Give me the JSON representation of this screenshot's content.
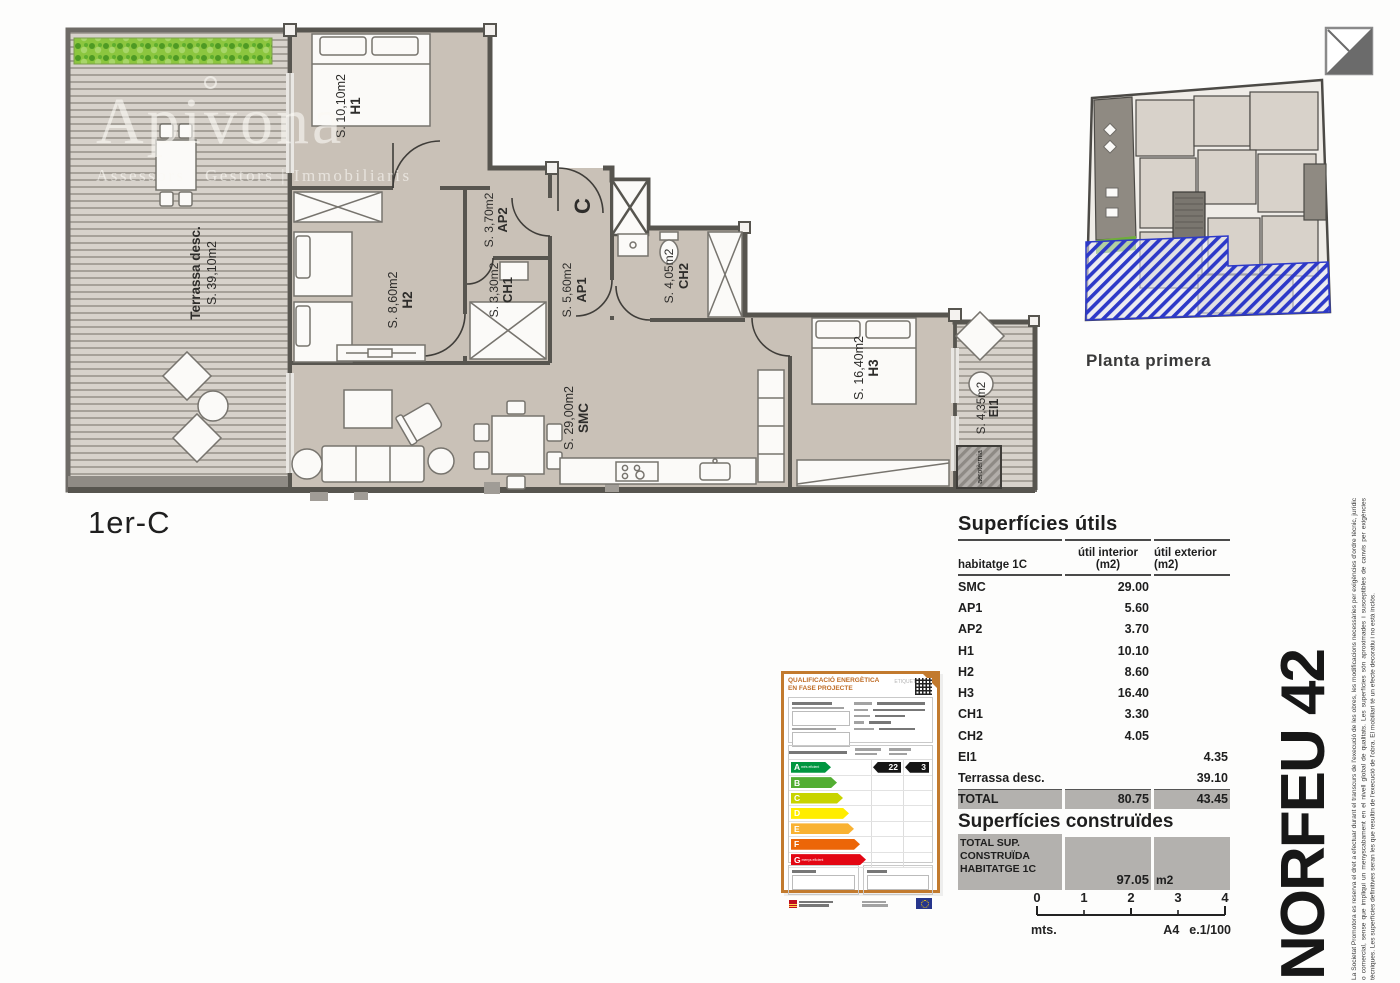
{
  "header": {
    "unit_label": "1er-C",
    "key_plan_label": "Planta primera",
    "brand": "NORFEU 42",
    "disclaimer": "La Societat Promotora es reserva el dret a efectuar durant el transcurs de l'execució de les obres, les modificacions necessàries per exigències d'ordre tècnic, jurídic o comercial, sense que impliqui un menyscabament en el nivell global de qualitats. Les superfícies són aproximades i susceptibles de canvis per exigències tècniques. Les superfícies definitives seran les que resultin de l'execució de l'obra. El mobiliari té un efecte decoratiu i no està inclòs."
  },
  "watermark": {
    "name": "Apivona",
    "tagline": "Assessors | Gestors | Immobiliaris"
  },
  "plan": {
    "rooms": {
      "terrassa": {
        "name": "Terrassa desc.",
        "area": "S. 39,10m2"
      },
      "h1": {
        "name": "H1",
        "area": "S. 10,10m2"
      },
      "h2": {
        "name": "H2",
        "area": "S. 8,60m2"
      },
      "h3": {
        "name": "H3",
        "area": "S. 16,40m2"
      },
      "ap1": {
        "name": "AP1",
        "area": "S. 5,60m2"
      },
      "ap2": {
        "name": "AP2",
        "area": "S. 3,70m2"
      },
      "ch1": {
        "name": "CH1",
        "area": "S. 3,30m2"
      },
      "ch2": {
        "name": "CH2",
        "area": "S. 4,05m2"
      },
      "ei1": {
        "name": "EI1",
        "area": "S. 4,35m2"
      },
      "smc": {
        "name": "SMC",
        "area": "S. 29,00m2"
      }
    },
    "entrance_label": "C",
    "equipment_label": "aerotèrmia"
  },
  "surfaces": {
    "title": "Superfícies útils",
    "columns": {
      "c1": "habitatge 1C",
      "c2a": "útil interior",
      "c2b": "(m2)",
      "c3a": "útil exterior",
      "c3b": "(m2)"
    },
    "rows": [
      {
        "label": "SMC",
        "interior": "29.00",
        "exterior": ""
      },
      {
        "label": "AP1",
        "interior": "5.60",
        "exterior": ""
      },
      {
        "label": "AP2",
        "interior": "3.70",
        "exterior": ""
      },
      {
        "label": "H1",
        "interior": "10.10",
        "exterior": ""
      },
      {
        "label": "H2",
        "interior": "8.60",
        "exterior": ""
      },
      {
        "label": "H3",
        "interior": "16.40",
        "exterior": ""
      },
      {
        "label": "CH1",
        "interior": "3.30",
        "exterior": ""
      },
      {
        "label": "CH2",
        "interior": "4.05",
        "exterior": ""
      },
      {
        "label": "EI1",
        "interior": "",
        "exterior": "4.35"
      },
      {
        "label": "Terrassa desc.",
        "interior": "",
        "exterior": "39.10"
      }
    ],
    "total": {
      "label": "TOTAL",
      "interior": "80.75",
      "exterior": "43.45"
    }
  },
  "built": {
    "title": "Superfícies construïdes",
    "label_l1": "TOTAL SUP.",
    "label_l2": "CONSTRUÏDA",
    "label_l3": "HABITATGE 1C",
    "value": "97.05",
    "unit": "m2"
  },
  "scale_bar": {
    "ticks": [
      "0",
      "1",
      "2",
      "3",
      "4"
    ],
    "unit": "mts.",
    "sheet": "A4",
    "scale": "e.1/100"
  },
  "energy": {
    "title_l1": "QUALIFICACIÓ ENERGÈTICA",
    "title_l2": "EN FASE PROJECTE",
    "tag": "ETIQUETA",
    "scale": [
      {
        "letter": "A",
        "label": "més eficient",
        "color": "#009640",
        "width": 40
      },
      {
        "letter": "B",
        "label": "",
        "color": "#52ae32",
        "width": 46
      },
      {
        "letter": "C",
        "label": "",
        "color": "#c8d400",
        "width": 52
      },
      {
        "letter": "D",
        "label": "",
        "color": "#ffed00",
        "width": 58
      },
      {
        "letter": "E",
        "label": "",
        "color": "#f9b233",
        "width": 63
      },
      {
        "letter": "F",
        "label": "",
        "color": "#ec6608",
        "width": 69
      },
      {
        "letter": "G",
        "label": "menys eficient",
        "color": "#e30613",
        "width": 75
      }
    ],
    "values": {
      "consumption": "22",
      "emissions": "3"
    }
  },
  "colors": {
    "wall": "#57554f",
    "room_fill": "#c9c1b7",
    "highlight_hatch": "#2d39c8",
    "card_border": "#c27a2e",
    "total_row_bg": "#b3b1ae"
  }
}
